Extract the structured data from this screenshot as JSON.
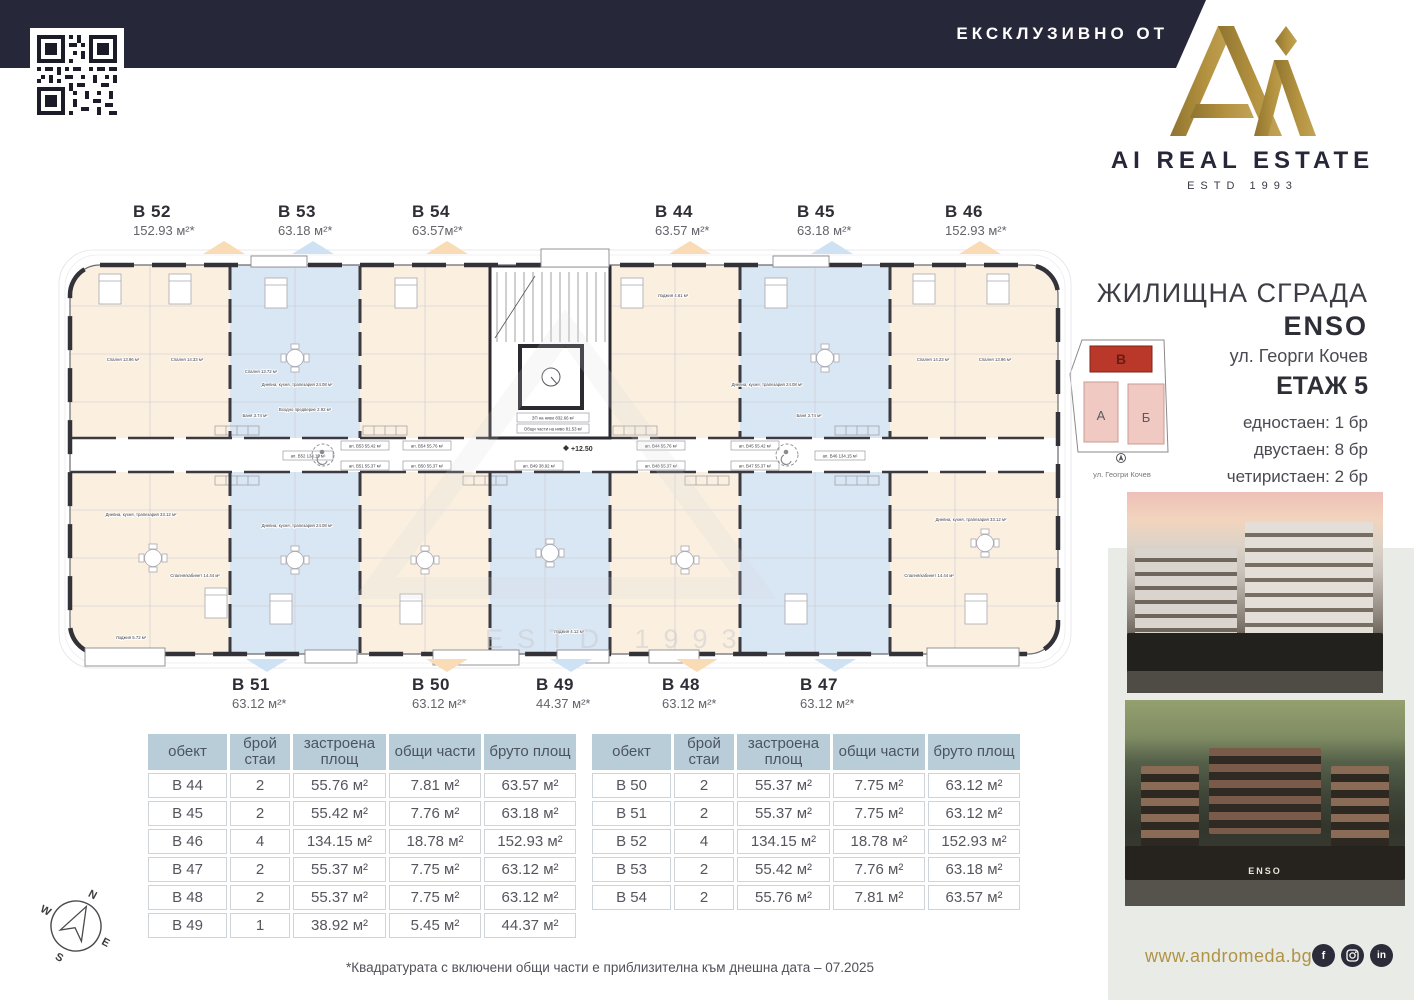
{
  "header": {
    "banner_label": "ЕКСКЛУЗИВНО ОТ",
    "brand_name": "AI REAL ESTATE",
    "brand_estd": "ESTD 1993"
  },
  "project": {
    "type_label": "ЖИЛИЩНА СГРАДА",
    "name": "ENSO",
    "address": "ул. Георги Кочев",
    "floor_label": "ЕТАЖ 5",
    "unit_mix": [
      "едностаен: 1 бр",
      "двустаен: 8 бр",
      "четиристаен: 2 бр"
    ],
    "siteplan": {
      "block_a": "А",
      "block_b": "Б",
      "block_v": "В",
      "caption": "ул. Геогри Кочев"
    }
  },
  "plan": {
    "level_mark": "+12.50",
    "watermark": "ESTD 1993",
    "core_note_1": "ЗП на ниво 832.66 м²",
    "core_note_2": "Общи части на ниво 81.53 м²",
    "top_units": [
      {
        "id": "B 52",
        "area": "152.93 м²*",
        "color": "orange"
      },
      {
        "id": "B 53",
        "area": "63.18 м²*",
        "color": "blue"
      },
      {
        "id": "B 54",
        "area": "63.57м²*",
        "color": "orange"
      },
      {
        "id": "B 44",
        "area": "63.57 м²*",
        "color": "orange"
      },
      {
        "id": "B 45",
        "area": "63.18 м²*",
        "color": "blue"
      },
      {
        "id": "B 46",
        "area": "152.93 м²*",
        "color": "orange"
      }
    ],
    "bottom_units": [
      {
        "id": "B 51",
        "area": "63.12 м²*",
        "color": "blue"
      },
      {
        "id": "B 50",
        "area": "63.12 м²*",
        "color": "orange"
      },
      {
        "id": "B 49",
        "area": "44.37 м²*",
        "color": "blue"
      },
      {
        "id": "B 48",
        "area": "63.12 м²*",
        "color": "orange"
      },
      {
        "id": "B 47",
        "area": "63.12 м²*",
        "color": "blue"
      }
    ],
    "corridor_labels": [
      "ап. B53 55.42 м²",
      "ап. B54 55.76 м²",
      "ап. B44 55.76 м²",
      "ап. B45 55.42 м²",
      "ап. B52 134.15 м²",
      "ап. B46 134.15 м²",
      "ап. B51 55.37 м²",
      "ап. B50 55.37 м²",
      "ап. B49 38.92 м²",
      "ап. B48 55.37 м²",
      "ап. B47 55.37 м²"
    ],
    "room_labels": [
      "Спалня 13.96 м²",
      "Спалня 14.33 м²",
      "Спалня 13.72 м²",
      "Дневна, кухня, трапезария 24.08 м²",
      "Баня 3.74 м²",
      "Входно предверие 2.92 м²",
      "Дневна, кухня, трапезария 33.12 м²",
      "Спалня/кабинет 14.44 м²",
      "Дневна, кухня, трапезария 24.08 м²",
      "Лоджия 5.72 м²",
      "Спалня 14.23 м²",
      "Спалня 13.96 м²",
      "Дневна, кухня, трапезария 24.08 м²",
      "Дневна, кухня, трапезария 33.12 м²",
      "Спалня/кабинет 14.44 м²",
      "Лоджия 4.61 м²",
      "Лоджия 4.12 м²",
      "Баня 3.74 м²"
    ]
  },
  "tables": {
    "headers": [
      "обект",
      "брой стаи",
      "застроена площ",
      "общи части",
      "бруто площ"
    ],
    "left_rows": [
      [
        "B 44",
        "2",
        "55.76 м²",
        "7.81 м²",
        "63.57 м²"
      ],
      [
        "B 45",
        "2",
        "55.42 м²",
        "7.76 м²",
        "63.18 м²"
      ],
      [
        "B 46",
        "4",
        "134.15 м²",
        "18.78 м²",
        "152.93 м²"
      ],
      [
        "B 47",
        "2",
        "55.37 м²",
        "7.75 м²",
        "63.12 м²"
      ],
      [
        "B 48",
        "2",
        "55.37 м²",
        "7.75 м²",
        "63.12 м²"
      ],
      [
        "B 49",
        "1",
        "38.92 м²",
        "5.45 м²",
        "44.37 м²"
      ]
    ],
    "right_rows": [
      [
        "B 50",
        "2",
        "55.37 м²",
        "7.75 м²",
        "63.12 м²"
      ],
      [
        "B 51",
        "2",
        "55.37 м²",
        "7.75 м²",
        "63.12 м²"
      ],
      [
        "B 52",
        "4",
        "134.15 м²",
        "18.78 м²",
        "152.93 м²"
      ],
      [
        "B 53",
        "2",
        "55.42 м²",
        "7.76 м²",
        "63.18 м²"
      ],
      [
        "B 54",
        "2",
        "55.76 м²",
        "7.81 м²",
        "63.57 м²"
      ]
    ]
  },
  "footnote": "*Квадратурата с включени общи части е приблизителна към днешна дата – 07.2025",
  "footer": {
    "website": "www.andromeda.bg",
    "social_f": "f",
    "social_in": "in"
  },
  "photos": {
    "sign": "ENSO"
  },
  "compass": {
    "n": "N",
    "e": "E",
    "s": "S",
    "w": "W"
  },
  "colors": {
    "navy": "#27273a",
    "gold": "#a8893e",
    "peach": "#fbf0e0",
    "blue": "#d9e6f3",
    "accent_red": "#b9382a",
    "table_header": "#b9cdd9"
  }
}
